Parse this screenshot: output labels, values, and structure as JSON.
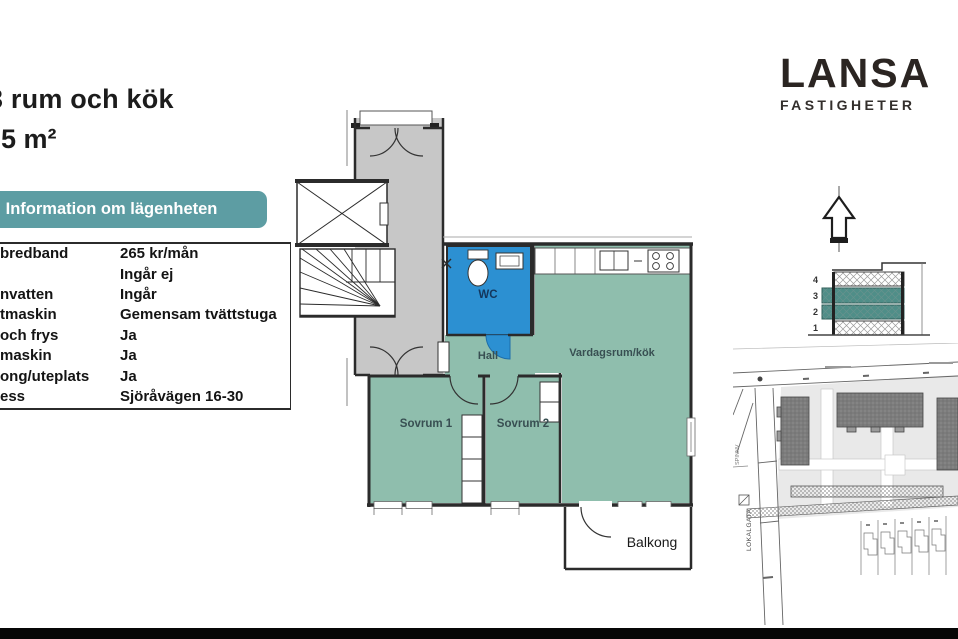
{
  "listing": {
    "title": "3 rum och kök",
    "area": "65 m²",
    "info_header": "Information om lägenheten",
    "info_rows": [
      {
        "label": "bredband",
        "value": "265 kr/mån"
      },
      {
        "label": "",
        "value": "Ingår ej"
      },
      {
        "label": "nvatten",
        "value": "Ingår"
      },
      {
        "label": "tmaskin",
        "value": "Gemensam tvättstuga"
      },
      {
        "label": "och frys",
        "value": "Ja"
      },
      {
        "label": "maskin",
        "value": "Ja"
      },
      {
        "label": "ong/uteplats",
        "value": "Ja"
      },
      {
        "label": "ess",
        "value": "Sjöråvägen 16-30"
      }
    ]
  },
  "brand": {
    "name": "LANSA",
    "subtitle": "FASTIGHETER"
  },
  "floorplan": {
    "labels": {
      "wc": "WC",
      "hall": "Hall",
      "living": "Vardagsrum/kök",
      "bedroom1": "Sovrum 1",
      "bedroom2": "Sovrum 2",
      "balcony": "Balkong"
    },
    "colors": {
      "room_teal": "#8fbead",
      "wc_blue": "#2c90d2",
      "corridor_gray": "#c7c7c7",
      "wall": "#2b2b2b"
    }
  },
  "section_diagram": {
    "floor_labels": [
      "4",
      "3",
      "2",
      "1"
    ],
    "highlighted_floors": [
      "3",
      "2"
    ],
    "highlight_color": "#4f8e88"
  },
  "site_plan": {
    "street_label_vertical": "LOKALGATA",
    "street_label_left": "SPINNV"
  },
  "accent_teal": "#5d9da3",
  "footer_bar_color": "#060606"
}
